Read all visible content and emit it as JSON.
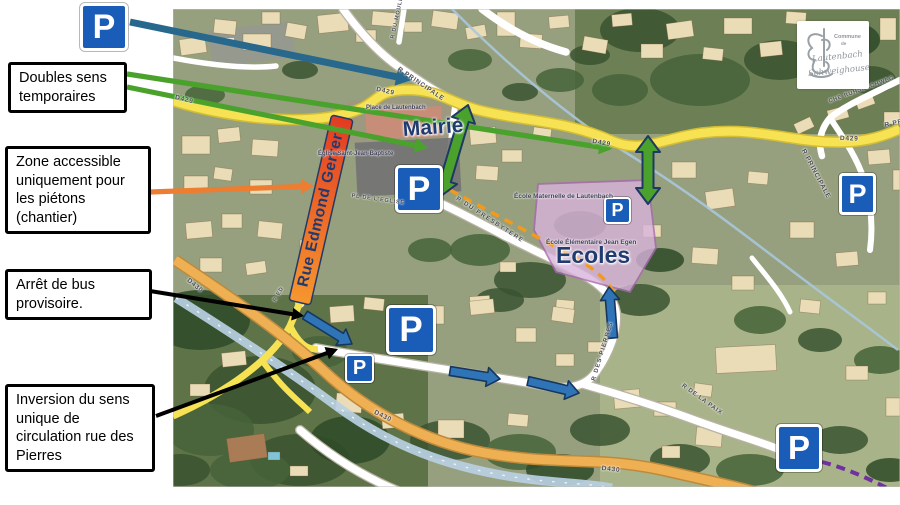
{
  "callouts": {
    "doubles_sens": "Doubles sens temporaires",
    "zone_accessible": "Zone accessible uniquement pour les piétons (chantier)",
    "arret_bus": "Arrêt de bus provisoire.",
    "inversion": "Inversion du sens unique de circulation rue des Pierres"
  },
  "overlay_labels": {
    "mairie": "Mairie",
    "ecoles": "Ecoles",
    "rue_edmond_gerrer": "Rue Edmond Gerrer",
    "parking_symbol": "P"
  },
  "map_labels": {
    "d429": "D429",
    "d430": "D430",
    "r_principale": "R PRINCIPALE",
    "r_du_moulin": "R DU MOULIN",
    "r_du_presbytere": "R DU PRESBYTERE",
    "r_des_pierres": "R DES PIERRES",
    "r_de_la_paix": "R DE LA PAIX",
    "che_ruhserchweg": "CHE RUHSERCHWEG",
    "r_ed": "R ED",
    "pl_de_leglise": "PL DE L'EGLISE",
    "place_lautenbach": "Place de Lautenbach",
    "eglise": "Église Saint-Jean-Baptiste",
    "ecole_maternelle": "École Maternelle de Lautenbach",
    "ecole_elementaire": "École Élémentaire Jean Egen"
  },
  "logo": {
    "commune": "Commune",
    "de": "de",
    "name1": "Lautenbach",
    "name2": "Schweighouse"
  },
  "colors": {
    "parking_blue": "#1a5db8",
    "arrow_green": "#4aa22d",
    "arrow_blue": "#2e74b6",
    "arrow_teal": "#27688c",
    "arrow_orange": "#ed7d31",
    "arrow_black": "#000000",
    "road_yellow": "#f6e252",
    "road_orange": "#efb054",
    "school_zone_pink": "#d9b3dc",
    "highlight_red": "#e23b23",
    "highlight_orange": "#f6962e",
    "label_navy": "#203b70"
  }
}
